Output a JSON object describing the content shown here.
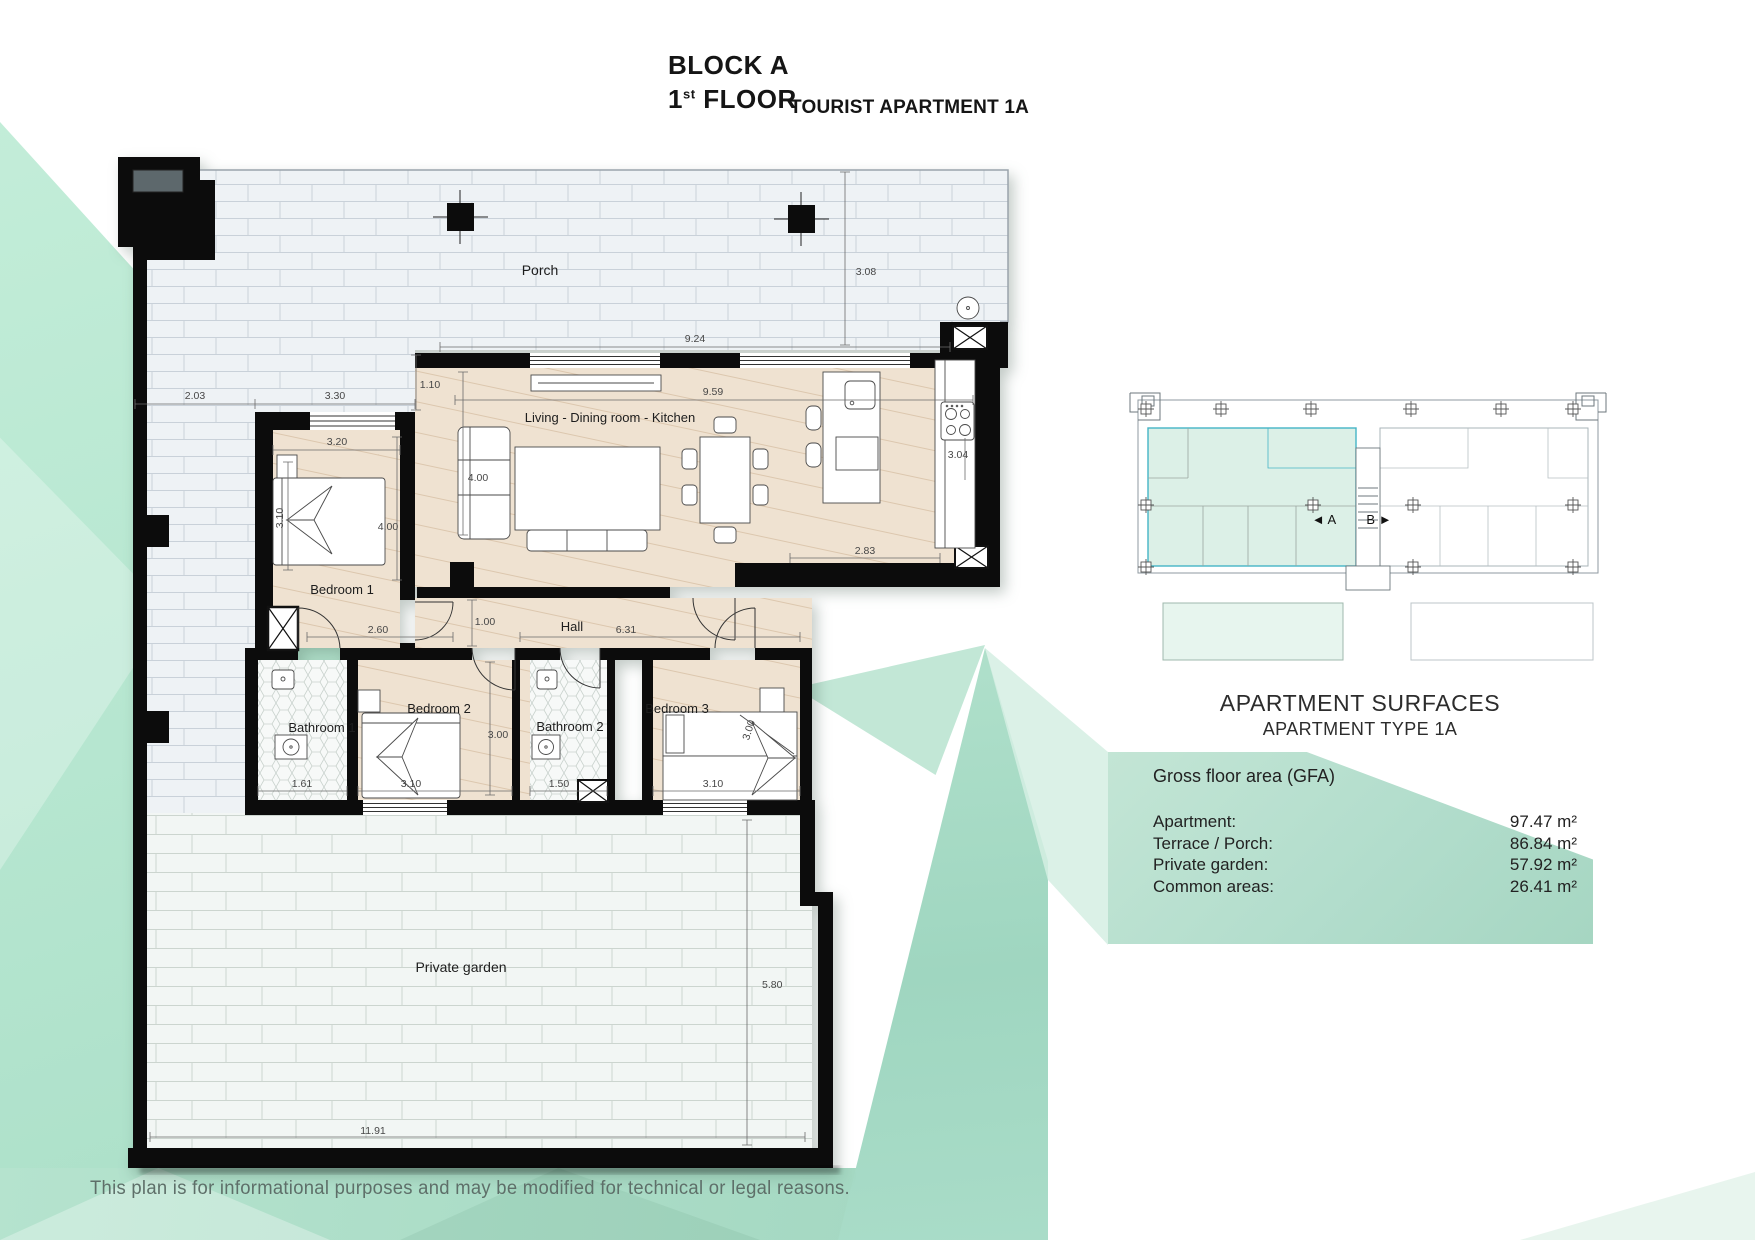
{
  "header": {
    "block_line": "BLOCK A",
    "floor_number": "1",
    "floor_ordinal": "st",
    "floor_label": "FLOOR",
    "subtitle": "TOURIST APARTMENT 1A"
  },
  "plan": {
    "labels": {
      "porch": "Porch",
      "living": "Living - Dining room - Kitchen",
      "bedroom1": "Bedroom 1",
      "bedroom2": "Bedroom 2",
      "bedroom3": "Bedroom 3",
      "bathroom1": "Bathroom 1",
      "bathroom2": "Bathroom 2",
      "hall": "Hall",
      "garden": "Private garden"
    },
    "dimensions": {
      "porch_width": "9.24",
      "porch_depth": "3.08",
      "terrace_left": "2.03",
      "bedroom1_top": "3.30",
      "wall_offset": "1.10",
      "living_width": "9.59",
      "living_height": "4.00",
      "bedroom1_width": "3.20",
      "bedroom1_side": "3.10",
      "bedroom1_height": "4.00",
      "kitchen_side": "3.04",
      "kitchen_bottom": "2.83",
      "hall_nook": "1.00",
      "hall_left": "2.60",
      "hall_right": "6.31",
      "bedrooms_depth": "3.00",
      "bedroom3_diag": "3.00",
      "bathroom1_width": "1.61",
      "bedroom2_width": "3.10",
      "bathroom2_width": "1.50",
      "bedroom3_width": "3.10",
      "garden_depth": "5.80",
      "garden_width": "11.91"
    }
  },
  "key_plan": {
    "unit_a": "◄ A",
    "unit_b": "B ►"
  },
  "surfaces": {
    "title": "APARTMENT SURFACES",
    "subtitle": "APARTMENT TYPE 1A",
    "gfa_heading": "Gross floor area (GFA)",
    "rows": [
      {
        "label": "Apartment:",
        "value": "97.47 m²"
      },
      {
        "label": "Terrace / Porch:",
        "value": "86.84 m²"
      },
      {
        "label": "Private garden:",
        "value": "57.92 m²"
      },
      {
        "label": "Common areas:",
        "value": "26.41 m²"
      }
    ]
  },
  "footer": {
    "disclaimer": "This plan is for informational purposes and may be modified for technical or legal reasons."
  },
  "colors": {
    "mint": "#bce9d4",
    "teal_wedge": "#a5d9c3",
    "panel_green": "#b2ddcc",
    "plan_wood": "#efe2d1",
    "plan_tile": "#eef2f5",
    "highlight_teal": "#45b5c6"
  }
}
